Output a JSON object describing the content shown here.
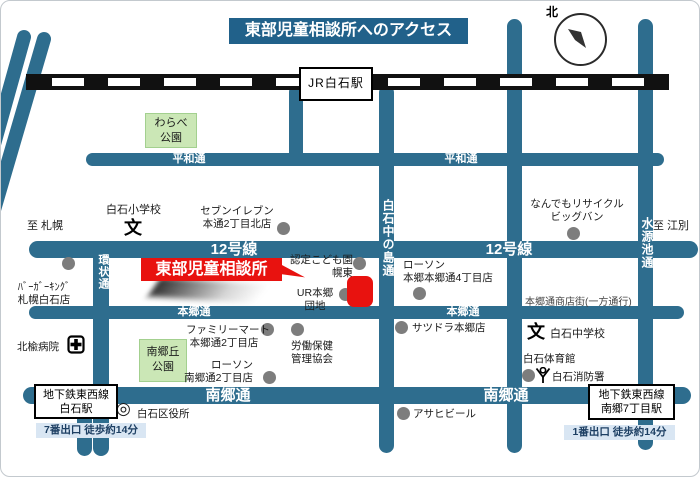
{
  "colors": {
    "road": "#2e6d8e",
    "title-bg": "#21618a",
    "red": "#e8120f",
    "park-bg": "#cbe7b6",
    "park-border": "#a3d08f",
    "exit-bg": "#d9e6f3",
    "exit-text": "#1d3f63",
    "dot": "#7d7d7d",
    "rail": "#111111"
  },
  "title": "東部児童相談所へのアクセス",
  "compass": {
    "north": "北"
  },
  "jr_station": "JR白石駅",
  "destination": {
    "label": "東部児童相談所"
  },
  "roads": {
    "heiwa": "平和通",
    "route12": "12号線",
    "hongo": "本郷通",
    "nango": "南郷通",
    "kanjo": "環状通",
    "nakanoshima": "白石中の島通",
    "suigenchi": "水源池通"
  },
  "shotengai": "本郷通商店街(一方通行)",
  "directions": {
    "sapporo": "至 札幌",
    "ebetsu": "至 江別"
  },
  "parks": {
    "warabe1": "わらべ",
    "warabe2": "公園",
    "nango1": "南郷丘",
    "nango2": "公園"
  },
  "pois": {
    "seven": {
      "l1": "セブンイレブン",
      "l2": "本通2丁目北店"
    },
    "bigbang": {
      "l1": "なんでもリサイクル",
      "l2": "ビッグバン"
    },
    "burgerking": {
      "l1": "ﾊﾞｰｶﾞｰｷﾝｸﾞ",
      "l2": "札幌白石店"
    },
    "nintei": {
      "l1": "認定こども園",
      "l2": "幌東"
    },
    "ur": {
      "l1": "UR本郷",
      "l2": "団地"
    },
    "lawson4": {
      "l1": "ローソン",
      "l2": "本郷本郷通4丁目店"
    },
    "famima": {
      "l1": "ファミリーマート",
      "l2": "本郷通2丁目店"
    },
    "rodohoken": {
      "l1": "労働保健",
      "l2": "管理協会"
    },
    "satudora": {
      "label": "サツドラ本郷店"
    },
    "lawson2": {
      "l1": "ローソン",
      "l2": "南郷通2丁目店"
    },
    "hokuyu": {
      "label": "北楡病院"
    },
    "elementary": {
      "label": "白石小学校"
    },
    "junior": {
      "label": "白石中学校"
    },
    "gym": {
      "label": "白石体育館"
    },
    "fire": {
      "label": "白石消防署"
    },
    "ward": {
      "label": "白石区役所"
    },
    "asahi": {
      "label": "アサヒビール"
    }
  },
  "subway_left": {
    "line": "地下鉄東西線",
    "station": "白石駅",
    "exit": "7番出口 徒歩約14分"
  },
  "subway_right": {
    "line": "地下鉄東西線",
    "station": "南郷7丁目駅",
    "exit": "1番出口 徒歩約14分"
  },
  "school_mark": "文",
  "ward_symbol": "◎"
}
